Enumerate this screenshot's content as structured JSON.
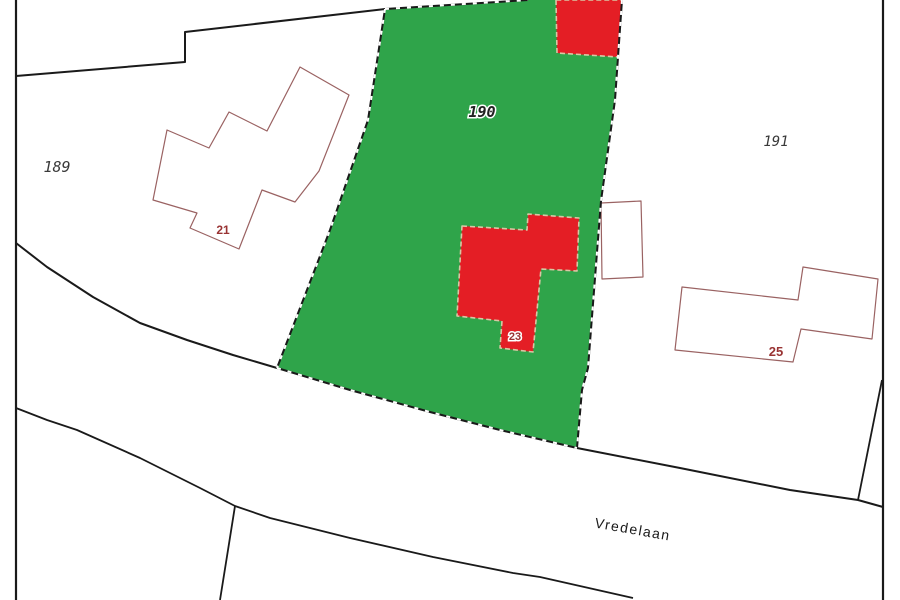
{
  "map": {
    "width": 900,
    "height": 600,
    "street_name": "Vredelaan",
    "parcel_numbers": [
      "189",
      "190",
      "191"
    ],
    "house_numbers": [
      "21",
      "23",
      "25"
    ],
    "highlighted_parcel": "190",
    "colors": {
      "background": "#ffffff",
      "parcel_highlight_green": "#2fa44a",
      "building_highlight_red": "#e41e25",
      "boundary_black": "#1a1a1a",
      "building_outline_brown": "#9a6262",
      "highlight_building_outline_tan": "#d8c7a4",
      "house_number_text": "#993333",
      "parcel_label_text": "#3a3a3a",
      "street_label_text": "#1a1a1a"
    },
    "shapes": [
      {
        "name": "parcel-190-highlight",
        "type": "polygon",
        "points": "385,9 528,0 622,0 615,100 601,201 588,368 582,390 577,448 500,430 430,412 350,390 277,368 330,230 368,120",
        "fill": "#2fa44a"
      },
      {
        "name": "building-21-outline",
        "type": "polygon",
        "points": "300,67 349,95 319,171 295,202 262,190 239,249 190,228 197,213 153,200 167,130 209,148 229,112 267,131",
        "fill": "#ffffff",
        "stroke": "#9a6262",
        "width": 1.2
      },
      {
        "name": "building-25-outline",
        "type": "polygon",
        "points": "682,287 798,300 803,267 878,279 872,339 801,329 793,362 675,350",
        "fill": "#ffffff",
        "stroke": "#9a6262",
        "width": 1.2
      },
      {
        "name": "building-191-annex-outline",
        "type": "polygon",
        "points": "601,203 641,201 643,277 602,279",
        "fill": "#ffffff",
        "stroke": "#9a6262",
        "width": 1.2
      },
      {
        "name": "building-top-red",
        "type": "polygon",
        "points": "556,0 557,53 618,57 622,0",
        "fill": "#e41e25",
        "stroke": "#d8c7a4",
        "width": 1.6,
        "dash": "5 3"
      },
      {
        "name": "building-23-red",
        "type": "polygon",
        "points": "462,226 527,230 528,214 579,218 577,271 541,269 533,352 500,348 502,321 457,316",
        "fill": "#e41e25",
        "stroke": "#d8c7a4",
        "width": 1.6,
        "dash": "5 3"
      },
      {
        "name": "boundary-north",
        "type": "polyline",
        "points": "16,76 185,62 185,32 385,9 528,0",
        "stroke": "#1a1a1a",
        "width": 2
      },
      {
        "name": "boundary-left-border",
        "type": "polyline",
        "points": "16,0 16,600",
        "stroke": "#1a1a1a",
        "width": 2.2
      },
      {
        "name": "boundary-right-border",
        "type": "polyline",
        "points": "883,0 883,600",
        "stroke": "#1a1a1a",
        "width": 2.2
      },
      {
        "name": "parcel-190-left-edge",
        "type": "polyline",
        "points": "385,9 368,120 330,230 277,368",
        "stroke": "#1a1a1a",
        "width": 2
      },
      {
        "name": "parcel-190-right-edge",
        "type": "polyline",
        "points": "622,0 615,100 601,201 588,368 582,390 577,448",
        "stroke": "#1a1a1a",
        "width": 2
      },
      {
        "name": "road-top-edge-west",
        "type": "polyline",
        "points": "16,243 47,267 93,297 140,323 187,340 233,355 277,368",
        "stroke": "#1a1a1a",
        "width": 2
      },
      {
        "name": "road-top-edge-mid",
        "type": "polyline",
        "points": "277,368 350,390 430,412 500,430 577,448",
        "stroke": "#1a1a1a",
        "width": 2
      },
      {
        "name": "road-top-edge-east",
        "type": "polyline",
        "points": "577,448 680,468 790,490 858,500 883,507",
        "stroke": "#1a1a1a",
        "width": 2
      },
      {
        "name": "road-bottom-edge",
        "type": "polyline",
        "points": "16,408 47,420 77,430 140,458 200,488 235,506 270,518 350,538 433,557 513,573 540,577 633,598",
        "stroke": "#1a1a1a",
        "width": 1.8
      },
      {
        "name": "boundary-branch-south",
        "type": "polyline",
        "points": "235,506 228,550 220,600",
        "stroke": "#1a1a1a",
        "width": 1.8
      },
      {
        "name": "boundary-corner-diagonal",
        "type": "polyline",
        "points": "882,380 858,500",
        "stroke": "#1a1a1a",
        "width": 1.8
      },
      {
        "name": "parcel-190-left-edge-dashes",
        "type": "polyline",
        "points": "385,9 368,120 330,230 277,368",
        "stroke": "#ffffff",
        "width": 2,
        "dash": "4 7"
      },
      {
        "name": "parcel-190-right-edge-dashes",
        "type": "polyline",
        "points": "622,0 615,100 601,201 588,368 582,390 577,448",
        "stroke": "#ffffff",
        "width": 2,
        "dash": "4 7"
      },
      {
        "name": "parcel-190-bottom-edge-dashes",
        "type": "polyline",
        "points": "277,368 350,390 430,412 500,430 577,448",
        "stroke": "#ffffff",
        "width": 2,
        "dash": "4 7"
      },
      {
        "name": "parcel-190-top-edge-dashes",
        "type": "polyline",
        "points": "385,9 528,0",
        "stroke": "#ffffff",
        "width": 2,
        "dash": "4 7"
      }
    ],
    "labels": [
      {
        "name": "parcel-label-189",
        "text": "189",
        "x": 57,
        "y": 172,
        "size": 15,
        "color": "#3a3a3a",
        "kind": "parcel"
      },
      {
        "name": "parcel-label-190",
        "text": "190",
        "x": 482,
        "y": 117,
        "size": 15,
        "color": "#222222",
        "kind": "parcel",
        "bold": true,
        "halo": true
      },
      {
        "name": "parcel-label-191",
        "text": "191",
        "x": 776,
        "y": 146,
        "size": 14,
        "color": "#3a3a3a",
        "kind": "parcel"
      },
      {
        "name": "house-number-21",
        "text": "21",
        "x": 223,
        "y": 234,
        "size": 12,
        "color": "#993333",
        "kind": "house"
      },
      {
        "name": "house-number-23",
        "text": "23",
        "x": 515,
        "y": 340,
        "size": 11,
        "color": "#993333",
        "kind": "house",
        "halo": true
      },
      {
        "name": "house-number-25",
        "text": "25",
        "x": 776,
        "y": 356,
        "size": 13,
        "color": "#993333",
        "kind": "house"
      },
      {
        "name": "street-label-vredelaan",
        "text": "Vredelaan",
        "x": 632,
        "y": 534,
        "size": 14,
        "color": "#1a1a1a",
        "kind": "street",
        "rotation": 10
      }
    ]
  }
}
